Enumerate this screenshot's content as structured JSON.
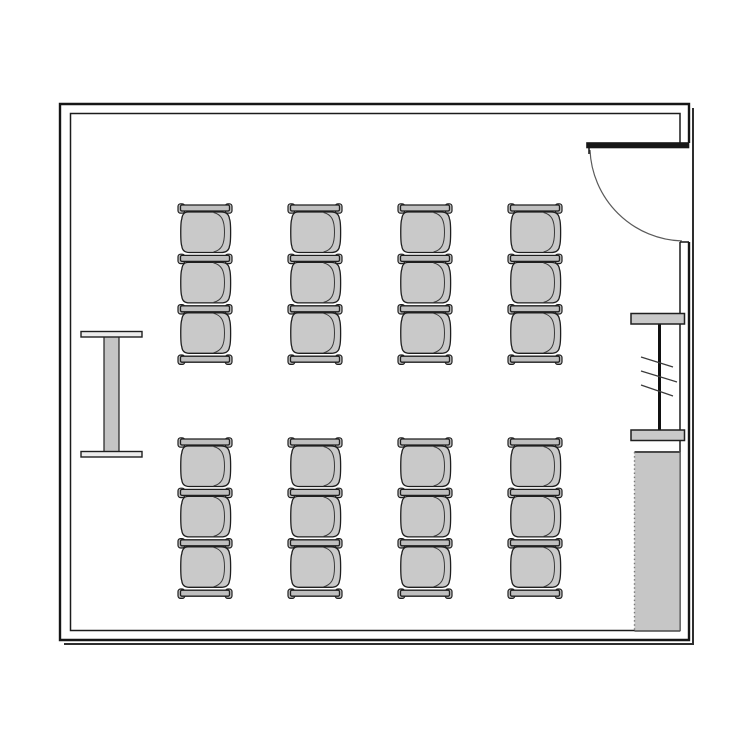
{
  "canvas": {
    "w": 750,
    "h": 750,
    "bg": "#ffffff"
  },
  "palette": {
    "wall": "#161616",
    "inner_wall": "#1c1c1c",
    "shadow": "#2e2e2e",
    "outline": "#1f1f1f",
    "seat_fill": "#c9c9c9",
    "bar_fill": "#bfbfbf",
    "seat_inner_line": "#3a3a3a",
    "table_bar_fill": "#ededed",
    "table_stem_fill": "#c4c4c4",
    "screen_bar_fill": "#c9c9c9",
    "screen_line": "#111111",
    "hatch": "#3a3a3a",
    "counter_fill": "#c6c6c6",
    "counter_edge": "#4a4a4a",
    "counter_dots": "#7a7a7a",
    "door_leaf": "#161616",
    "door_arc": "#5a5a5a"
  },
  "room": {
    "outer_path": "M 689,143 L 689,104 L 60,104 L 60,640 L 689,640 L 689,242",
    "inner_path": "M 680,143 L 680,113.5 L 70.5,113.5 L 70.5,630.5 L 680,630.5 L 680,242",
    "shadow_path": "M 693,108 L 693,644 L 64,644",
    "outer_stroke_w": 2.4,
    "inner_stroke_w": 1.5,
    "shadow_stroke_w": 2
  },
  "door": {
    "leaf": {
      "x": 586.5,
      "y": 142.5,
      "w": 102.5,
      "h": 5.5
    },
    "hinge_tick": {
      "x1": 589,
      "y1": 148,
      "x2": 589,
      "y2": 154
    },
    "arc_path": "M 590,150 A 95 95 0 0 0 682,241",
    "jamb_cap": {
      "x1": 680,
      "y1": 242,
      "x2": 689,
      "y2": 242
    }
  },
  "table": {
    "top_bar": {
      "x": 81,
      "y": 331.5,
      "w": 61,
      "h": 5.5
    },
    "stem": {
      "x": 104,
      "y": 336.5,
      "w": 15,
      "h": 116
    },
    "bottom_bar": {
      "x": 81,
      "y": 451.5,
      "w": 61,
      "h": 5.5
    }
  },
  "screen": {
    "top_bar": {
      "x": 631,
      "y": 313.5,
      "w": 53.5,
      "h": 10.5
    },
    "bottom_bar": {
      "x": 631,
      "y": 430,
      "w": 53.5,
      "h": 10.5
    },
    "line": {
      "x": 659.5,
      "y1": 314,
      "y2": 440
    },
    "hatches": [
      {
        "x1": 641,
        "y1": 357,
        "x2": 673,
        "y2": 367
      },
      {
        "x1": 641,
        "y1": 371,
        "x2": 677,
        "y2": 382
      },
      {
        "x1": 641,
        "y1": 385,
        "x2": 673,
        "y2": 396
      }
    ]
  },
  "counter": {
    "x": 634.5,
    "y": 452,
    "w": 45.5,
    "h": 179
  },
  "seating": {
    "rows": [
      {
        "y": 205
      },
      {
        "y": 439
      }
    ],
    "columns": [
      178,
      288,
      398,
      508
    ],
    "chairs_per_group": 3,
    "chair_pitch": 50.4,
    "group_width": 54,
    "bar": {
      "body": {
        "x": 2.5,
        "y": 0,
        "w": 49,
        "h": 6,
        "rx": 1.5
      },
      "caps": [
        {
          "x": 0,
          "y": -1.2,
          "w": 6.8,
          "h": 9.4,
          "rx": 2.6
        },
        {
          "x": 47.2,
          "y": -1.2,
          "w": 6.8,
          "h": 9.4,
          "rx": 2.6
        }
      ]
    },
    "seat_path": "M 10,7 L 43,7 C 48.5,7 51,9.5 51.5,14 C 53,17 53,37.5 51.5,41 C 51,45.5 48,47.5 43,47.5 L 11.5,47.5 C 7,47.5 4.2,45.5 3.8,41 C 2.4,37.5 2.4,17 3.8,14 C 4.2,9.5 6.5,7 10,7 Z",
    "seat_inner_path": "M 35.5,7.5 C 43.5,9.5 46.5,15 46.5,27.2 C 46.5,39.5 43.5,45 35.5,47",
    "total_chairs": 24,
    "total_groups": 8
  }
}
